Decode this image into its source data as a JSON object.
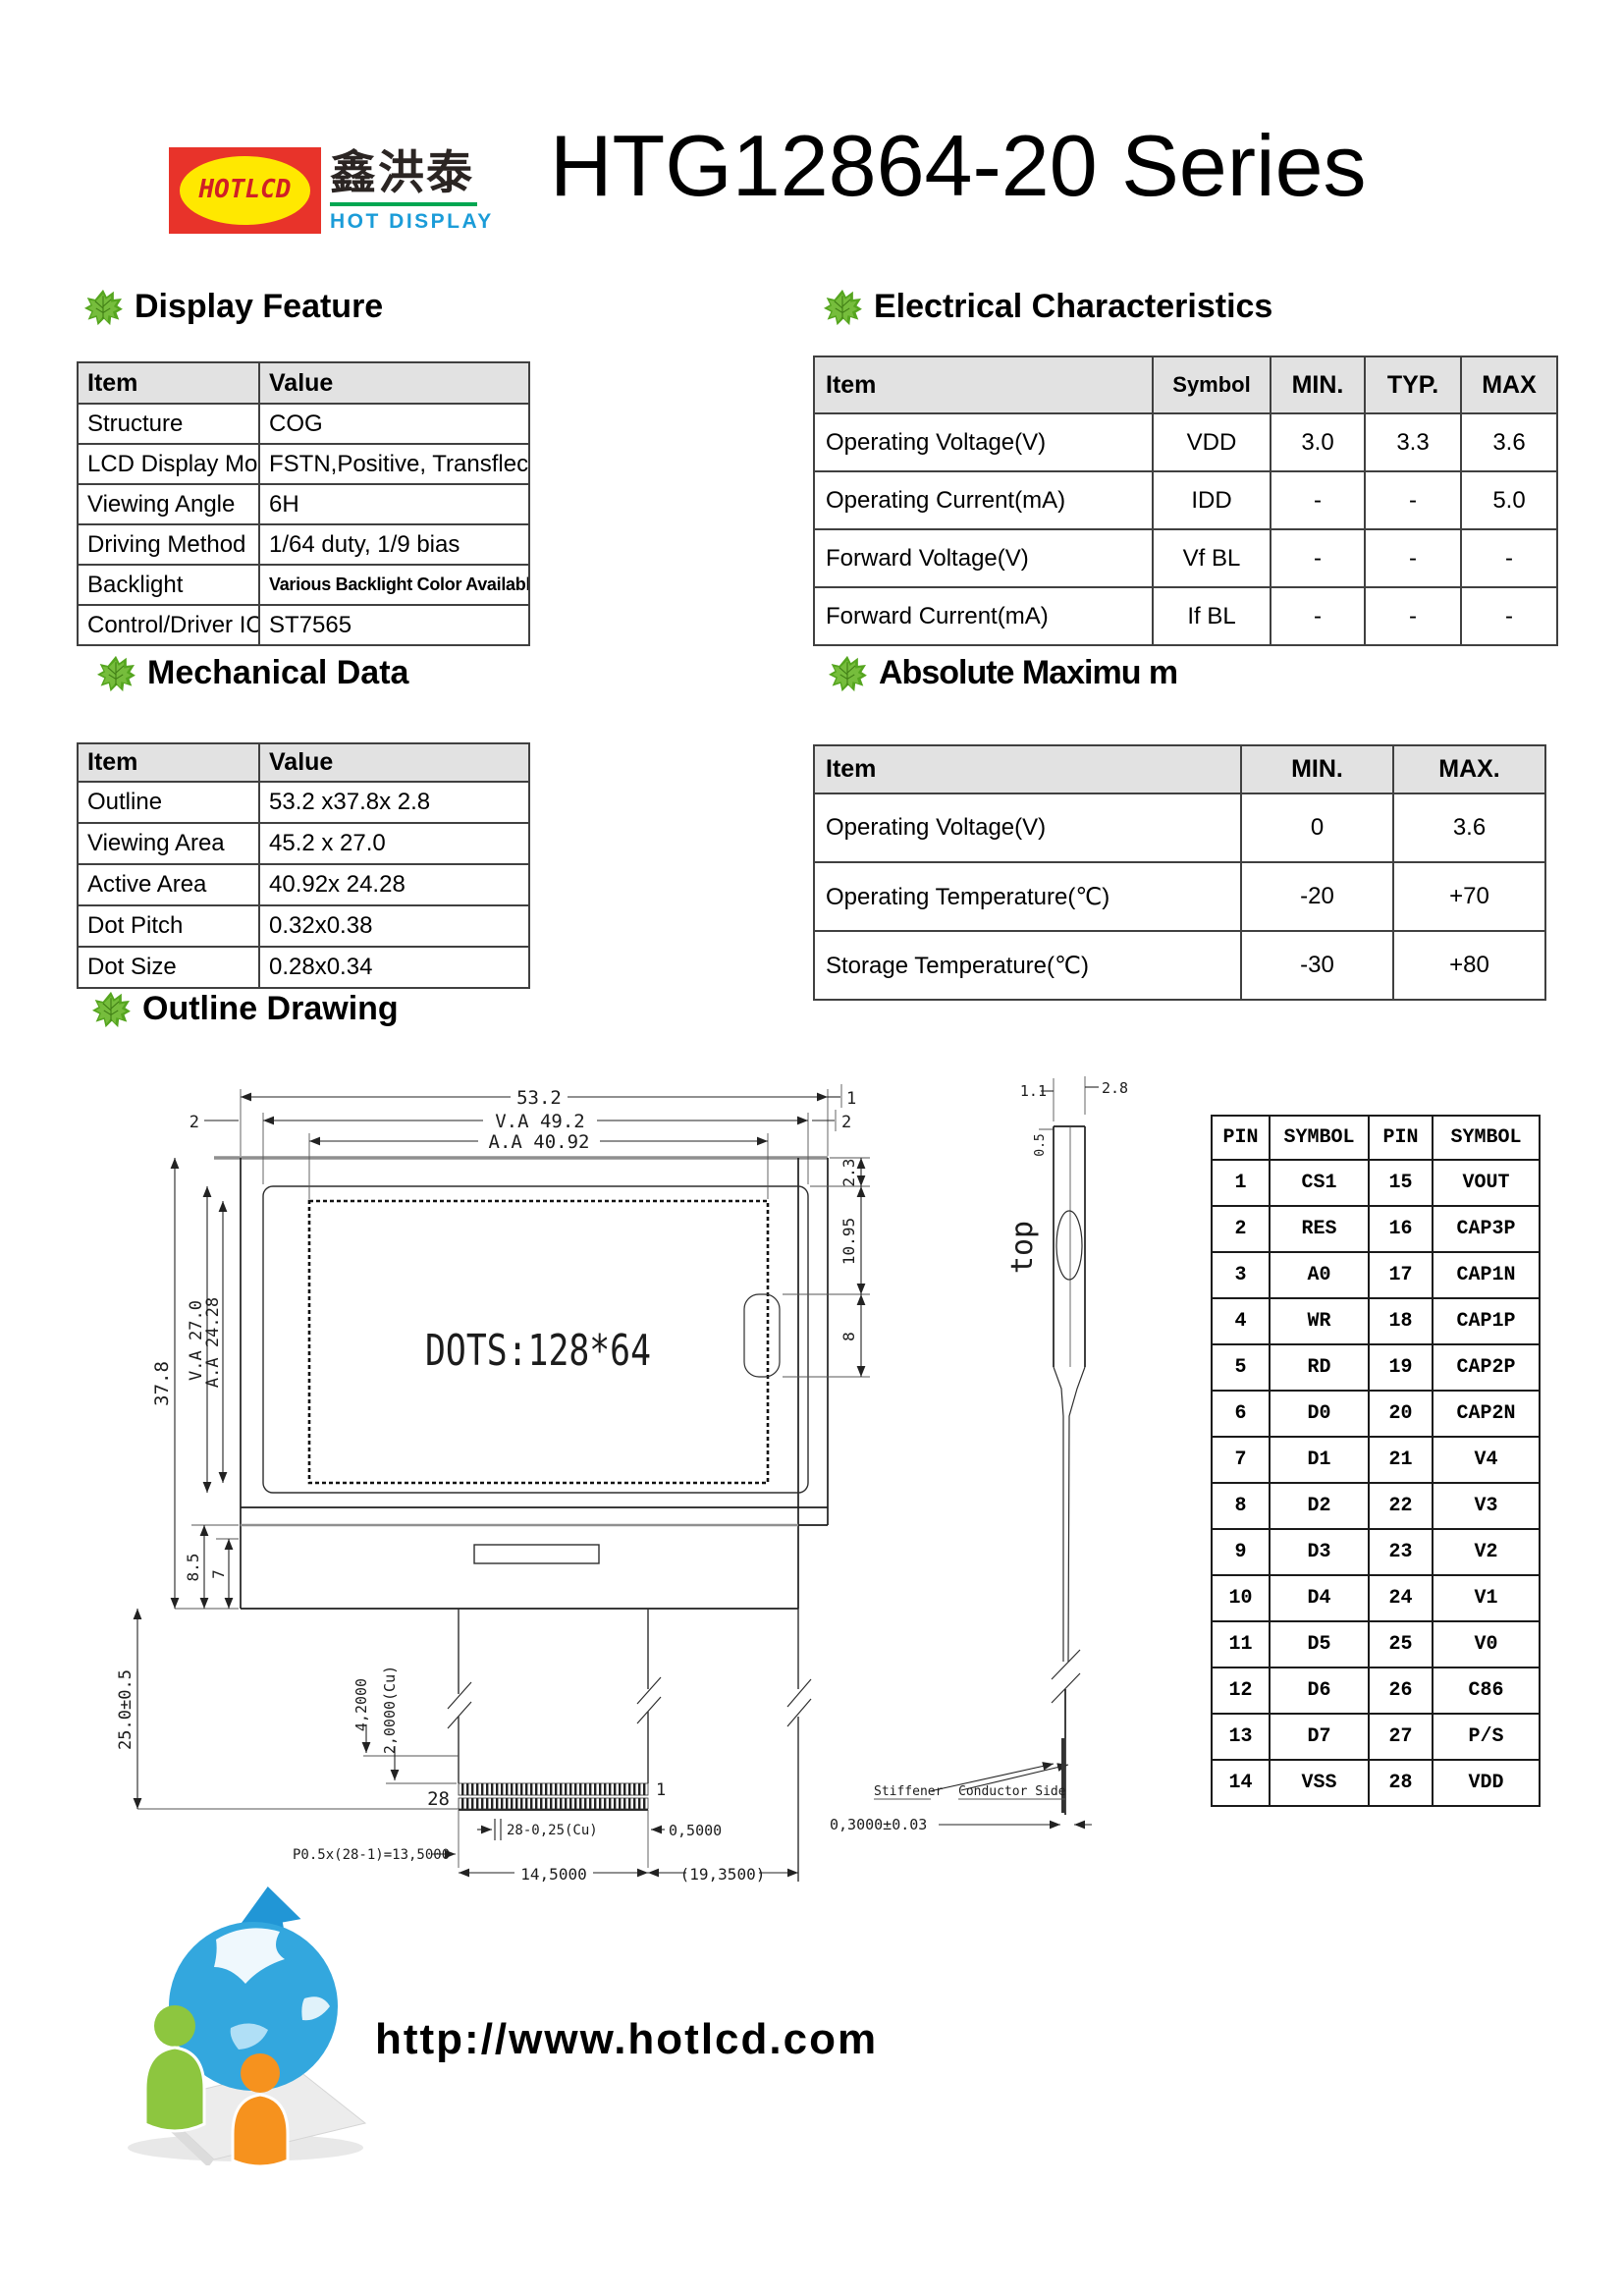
{
  "header": {
    "title": "HTG12864-20 Series",
    "logo": {
      "badge_text": "HOTLCD",
      "chinese_text": "鑫洪泰",
      "tagline": "HOT DISPLAY",
      "colors": {
        "badge_bg": "#e8332a",
        "badge_ellipse": "#ffe800",
        "badge_text": "#d01f26",
        "tagline": "#1b9cd8",
        "underline": "#00a651",
        "leaf_green": "#55a51f"
      }
    }
  },
  "display_feature": {
    "title": "Display Feature",
    "headers": [
      "Item",
      "Value"
    ],
    "rows": [
      [
        "Structure",
        "COG"
      ],
      [
        "LCD Display Mode",
        "FSTN,Positive, Transflective"
      ],
      [
        "Viewing Angle",
        "6H"
      ],
      [
        "Driving Method",
        "1/64 duty, 1/9 bias"
      ],
      [
        "Backlight",
        "Various Backlight Color Available"
      ],
      [
        "Control/Driver IC",
        "ST7565"
      ]
    ]
  },
  "electrical": {
    "title": "Electrical Characteristics",
    "headers": [
      "Item",
      "Symbol",
      "MIN.",
      "TYP.",
      "MAX"
    ],
    "rows": [
      [
        "Operating Voltage(V)",
        "VDD",
        "3.0",
        "3.3",
        "3.6"
      ],
      [
        "Operating Current(mA)",
        "IDD",
        "-",
        "-",
        "5.0"
      ],
      [
        "Forward Voltage(V)",
        "Vf BL",
        "-",
        "-",
        "-"
      ],
      [
        "Forward Current(mA)",
        "If BL",
        "-",
        "-",
        "-"
      ]
    ]
  },
  "mechanical": {
    "title": "Mechanical Data",
    "headers": [
      "Item",
      "Value"
    ],
    "rows": [
      [
        "Outline",
        "53.2 x37.8x 2.8"
      ],
      [
        "Viewing Area",
        "45.2 x 27.0"
      ],
      [
        "Active Area",
        "40.92x 24.28"
      ],
      [
        "Dot Pitch",
        "0.32x0.38"
      ],
      [
        "Dot Size",
        "0.28x0.34"
      ]
    ]
  },
  "absolute_maximum": {
    "title": "Absolute Maximu m",
    "headers": [
      "Item",
      "MIN.",
      "MAX."
    ],
    "rows": [
      [
        "Operating Voltage(V)",
        "0",
        "3.6"
      ],
      [
        "Operating Temperature(℃)",
        "-20",
        "+70"
      ],
      [
        "Storage Temperature(℃)",
        "-30",
        "+80"
      ]
    ]
  },
  "outline_drawing": {
    "title": "Outline Drawing",
    "screen_text": "DOTS:128*64",
    "dims": {
      "total_width": "53.2",
      "va_width": "V.A 49.2",
      "aa_width": "A.A 40.92",
      "left_gap": "2",
      "right_gap1": "1",
      "right_gap2": "2",
      "edge_2_3": "2.3",
      "edge_10_95": "10.95",
      "edge_8": "8",
      "total_height": "37.8",
      "va_height": "V.A 27.0",
      "aa_height": "A.A 24.28",
      "lower_8_5": "8.5",
      "lower_7": "7",
      "fpc_length": "25.0±0.5",
      "cu_4_2": "4,2000",
      "cu_2_0": "2,0000(Cu)",
      "pin_28": "28",
      "pin_1": "1",
      "pitch": "P0.5x(28-1)=13,5000",
      "pin_width": "28-0,25(Cu)",
      "end_gap": "0,5000",
      "fpc_span": "14,5000",
      "right_span": "(19,3500)",
      "side_1_1": "1.1",
      "side_2_8": "2.8",
      "side_0_5": "0.5",
      "side_top": "top",
      "stiffener": "Stiffener",
      "conductor_side": "Conductor Side",
      "thickness": "0,3000±0.03"
    }
  },
  "pin_table": {
    "headers": [
      "PIN",
      "SYMBOL",
      "PIN",
      "SYMBOL"
    ],
    "rows": [
      [
        "1",
        "CS1",
        "15",
        "VOUT"
      ],
      [
        "2",
        "RES",
        "16",
        "CAP3P"
      ],
      [
        "3",
        "A0",
        "17",
        "CAP1N"
      ],
      [
        "4",
        "WR",
        "18",
        "CAP1P"
      ],
      [
        "5",
        "RD",
        "19",
        "CAP2P"
      ],
      [
        "6",
        "D0",
        "20",
        "CAP2N"
      ],
      [
        "7",
        "D1",
        "21",
        "V4"
      ],
      [
        "8",
        "D2",
        "22",
        "V3"
      ],
      [
        "9",
        "D3",
        "23",
        "V2"
      ],
      [
        "10",
        "D4",
        "24",
        "V1"
      ],
      [
        "11",
        "D5",
        "25",
        "V0"
      ],
      [
        "12",
        "D6",
        "26",
        "C86"
      ],
      [
        "13",
        "D7",
        "27",
        "P/S"
      ],
      [
        "14",
        "VSS",
        "28",
        "VDD"
      ]
    ]
  },
  "footer": {
    "url": "http://www.hotlcd.com"
  }
}
